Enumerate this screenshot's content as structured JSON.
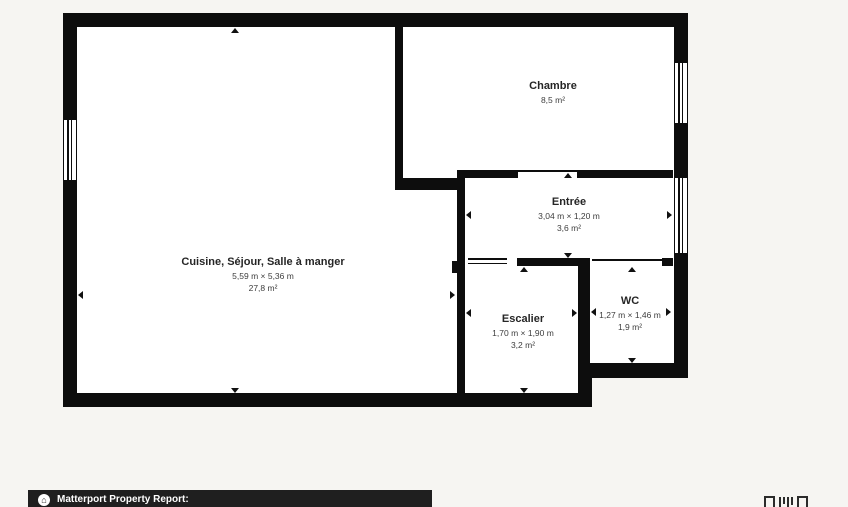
{
  "page": {
    "background_color": "#f6f5f2"
  },
  "floorplan": {
    "colors": {
      "wall": "#0d0d0d",
      "room_fill": "#ffffff",
      "label_text": "#3d3d3d"
    },
    "rooms": {
      "cuisine": {
        "name": "Cuisine, Séjour, Salle à manger",
        "dimensions": "5,59 m × 5,36 m",
        "area": "27,8 m²"
      },
      "chambre": {
        "name": "Chambre",
        "area": "8,5 m²"
      },
      "entree": {
        "name": "Entrée",
        "dimensions": "3,04 m × 1,20 m",
        "area": "3,6 m²"
      },
      "escalier": {
        "name": "Escalier",
        "dimensions": "1,70 m × 1,90 m",
        "area": "3,2 m²"
      },
      "wc": {
        "name": "WC",
        "dimensions": "1,27 m × 1,46 m",
        "area": "1,9 m²"
      }
    }
  },
  "footer": {
    "label": "Matterport Property Report:",
    "icon": "house-circle-icon",
    "bar_color": "#1f1f1f",
    "house_glyph": "⌂"
  }
}
